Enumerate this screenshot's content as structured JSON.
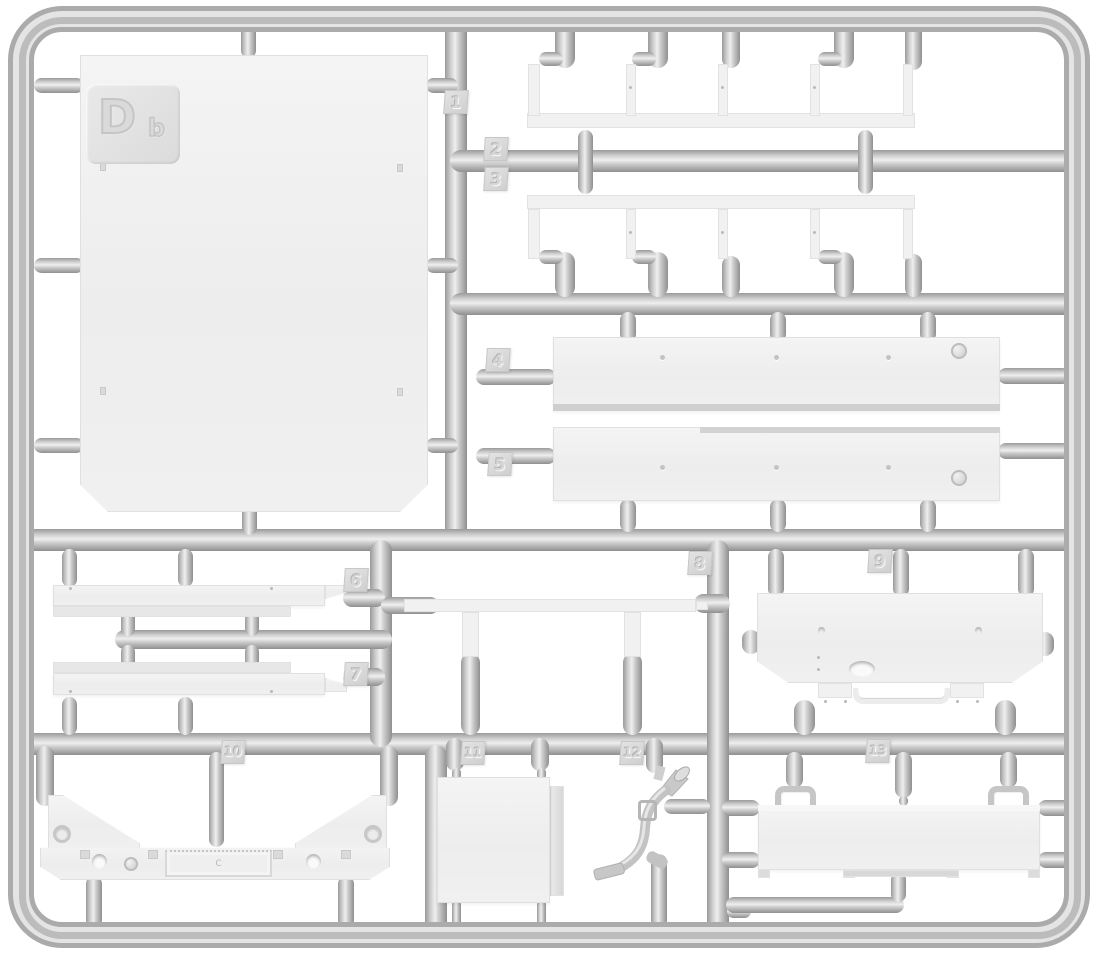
{
  "sprue": {
    "code": {
      "letter": "D",
      "sub": "b"
    },
    "part_tags": {
      "t1": "1",
      "t2": "2",
      "t3": "3",
      "t4": "4",
      "t5": "5",
      "t6": "6",
      "t7": "7",
      "t8": "8",
      "t9": "9",
      "t10": "10",
      "t11": "11",
      "t12": "12",
      "t13": "13"
    },
    "plate_mark": "C"
  },
  "colors": {
    "background": "#ffffff",
    "plastic_part": "#f0f0f0",
    "runner": "#c6c6c6",
    "runner_highlight": "#efefef",
    "runner_shadow": "#969696",
    "tag_face": "#d8d8d8",
    "frame": "#c4c4c4"
  }
}
